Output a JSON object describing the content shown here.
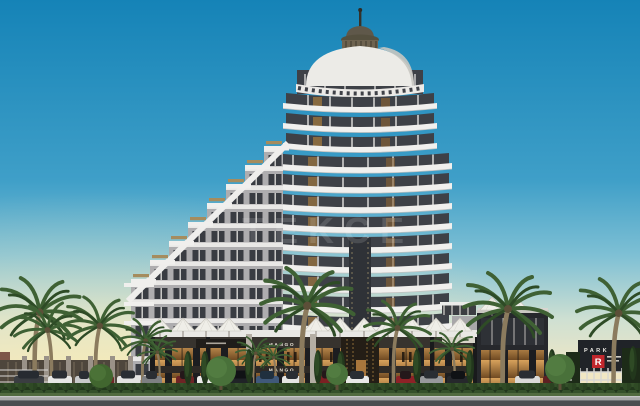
{
  "image": {
    "type": "architectural-render",
    "subject": "Dusk render of a cylindrical high-rise residence tower with white curved balconies, a domed crown, a stepped terrace wing, retail podium with lit shops, palm trees, hedge and parked cars"
  },
  "watermark": {
    "text": "TEKCE"
  },
  "signs": {
    "store_upper": "MANGO",
    "store_lower": "MANGO",
    "gate_title": "PARK",
    "gate_letter": "R"
  },
  "colors": {
    "sky_top": "#1583b7",
    "sky_mid": "#3f9fc8",
    "sky_low": "#7fc0d4",
    "sky_haze": "#cfe0d2",
    "horizon_warm": "#f1e7c4",
    "slab_white": "#f1f0ee",
    "floor_dark": "#3e4147",
    "facade_gray": "#aeadaf",
    "dome_white": "#ecebe7",
    "drum_bronze": "#6e6350",
    "glass_warm_top": "#d8a25c",
    "glass_warm_bottom": "#6f4a22",
    "fascia_dark": "#37332e",
    "sign_red": "#c1272d",
    "palm_green": "#3f6134",
    "hedge_green": "#22371c",
    "road_gray": "#4a4d50",
    "sidewalk_gray": "#a8a9a8"
  }
}
